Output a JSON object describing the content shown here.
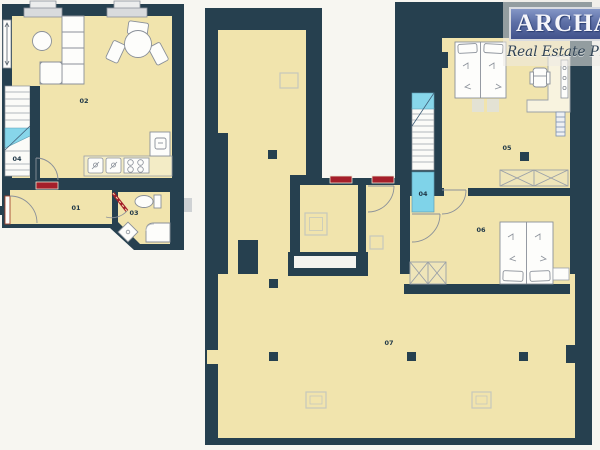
{
  "logo": {
    "brand": "ARCHA",
    "tagline": "Real Estate Prague"
  },
  "rooms": {
    "left_living": "02",
    "left_stairs": "04",
    "left_hall": "01",
    "left_bath": "03",
    "right_bedroom_top": "05",
    "right_landing": "04",
    "right_bedroom_mid": "06",
    "right_hall": "07"
  },
  "colors": {
    "wall": "#26404f",
    "floor": "#f1e4ad",
    "stairs_blue": "#87d6ea",
    "door_red": "#a51f2a",
    "background": "#f7f6f1",
    "furniture_outline": "#8a9099"
  }
}
